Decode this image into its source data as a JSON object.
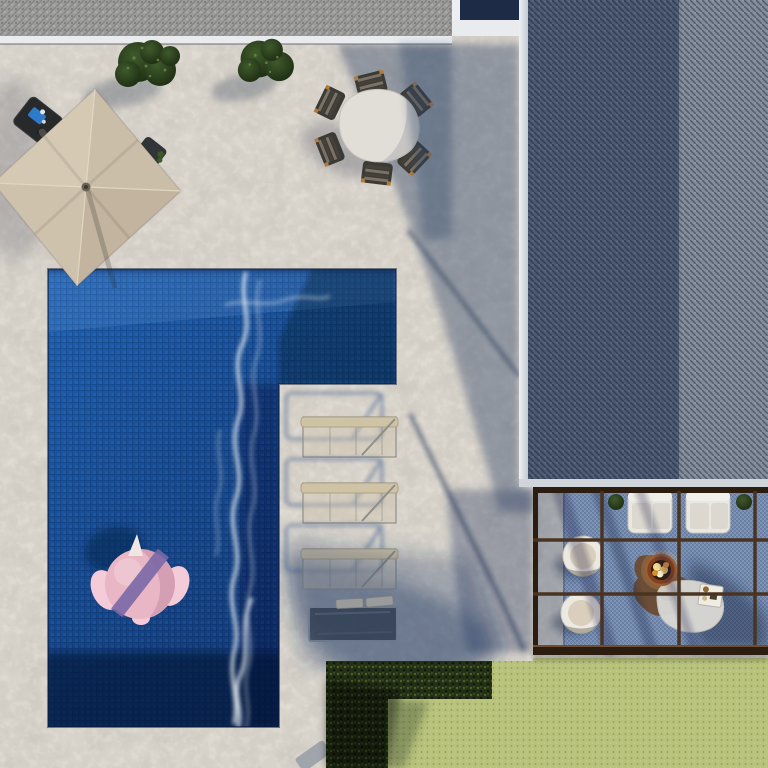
{
  "meta": {
    "type": "3d-architectural-render",
    "view": "top-down aerial",
    "subject": "villa pool terrace with pergola lounge",
    "visible_text": []
  },
  "scene": {
    "areas": [
      "stone-patio",
      "gravel-roof-strip",
      "main-roof",
      "l-shaped-pool",
      "lawn",
      "hedge",
      "pergola-lounge"
    ],
    "counts": {
      "dining_chairs": 6,
      "sun_loungers": 3,
      "pergola_armchairs": 2,
      "pergola_round_chairs": 2,
      "bushes": 2,
      "pool_floats": 1,
      "fire_pits": 1
    },
    "objects": [
      "cantilever-umbrella",
      "umbrella-side-table",
      "drinks-tray",
      "planter-stool",
      "dining-table",
      "dining-chairs",
      "boxwood-bushes",
      "swimming-pool",
      "flamingo-float",
      "water-foam",
      "sun-loungers",
      "low-glass-bench",
      "stepping-stone",
      "pergola-frame",
      "blue-rug",
      "white-armchairs",
      "round-lounge-chairs",
      "fire-pit",
      "coffee-table",
      "serving-tray",
      "potted-plants",
      "lawn",
      "hedge",
      "roof-gutter",
      "roof-shingles"
    ]
  },
  "colors": {
    "stone-base": "#d9d4cb",
    "stone-dark": "#c7c0b4",
    "gravel": "#9c9c9a",
    "fascia": "#e9ebee",
    "window-dark": "#1d2b47",
    "gutter": "#dde2e8",
    "roof-dark": "#4c5a74",
    "roof-light": "#838c9b",
    "roof-fascia": "#d0d5dc",
    "beam": "#4a3421",
    "beam-dark": "#2b1d10",
    "beam-hl": "#6e4f2e",
    "rug": "#7289ad",
    "pool-1": "#2062b2",
    "pool-2": "#164c94",
    "pool-3": "#0f3570",
    "foam": "#f3f8fd",
    "float-pink": "#e9b6c6",
    "float-pink-lt": "#f4cbd8",
    "float-purple": "#7a68a6",
    "float-cream": "#f0e7e3",
    "umb-n": "#cbbea8",
    "umb-e": "#c2b49e",
    "umb-s": "#cfc2ac",
    "umb-w": "#d6c9b4",
    "umb-hub": "#6b6257",
    "umb-arm": "#4f4b46",
    "sidetable": "#27292b",
    "tray-blue": "#2e7fd4",
    "stool": "#323537",
    "bush-1": "#3f5a2b",
    "bush-2": "#1c2a12",
    "bush-spk": "#6c8a44",
    "table-top": "#e1ded7",
    "chair-dark": "#3c3a35",
    "chair-lt": "#7a7264",
    "chair-md": "#45413a",
    "chair-wood": "#b07a3e",
    "lounger-bar": "#cfc3a6",
    "lounger-frame": "#8f8f8a",
    "lounger-sh": "#3d5a8e",
    "bench-fill": "#161e2a",
    "bench-frame": "#8e959d",
    "cushion": "#cfc6b2",
    "lawn": "#b8c27b",
    "hedge": "#243016",
    "sofa": "#e9e7e1",
    "sofa-back": "#f1efe9",
    "sofa-cushion": "#dcd8cf",
    "rchair": "#ece9e2",
    "rchair-cushion": "#d9cfbc",
    "fire-rust": "#83401f",
    "fire-rim": "#9a5f35",
    "fire-core": "#2f1d0f",
    "flame-1": "#f4dc90",
    "flame-2": "#eec068",
    "slab": "#6b4a30",
    "ctable": "#d8d7d3",
    "tray": "#efece3",
    "step-stone": "#9aa0a8",
    "plant": "#3c5a26"
  }
}
